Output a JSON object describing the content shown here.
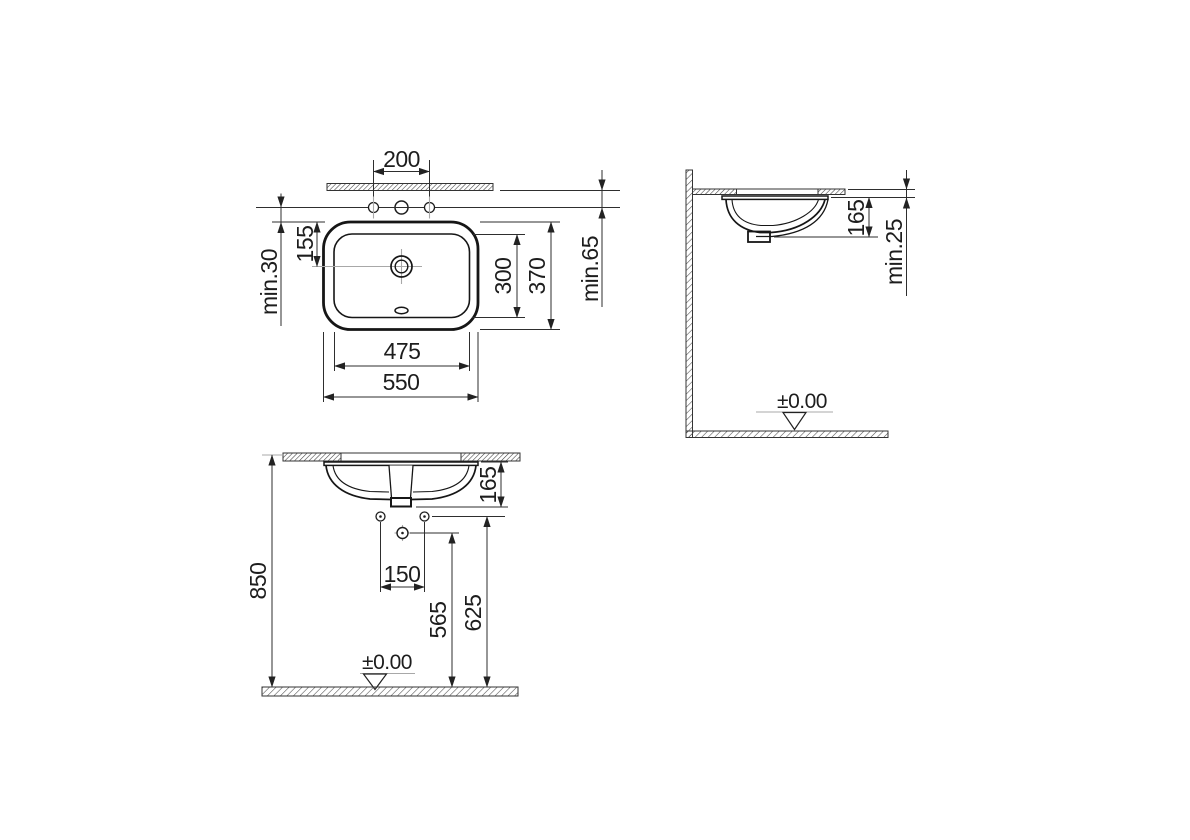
{
  "drawing": {
    "background": "#ffffff",
    "line_color": "#161616",
    "dimension_color": "#2e2e2e",
    "centerline_color": "#a8a8a8",
    "plan": {
      "tap_hole_spacing": "200",
      "edge_to_tap_min": "min.65",
      "tap_to_rim_min": "min.30",
      "rim_to_drain": "155",
      "bowl_depth": "300",
      "overall_depth": "370",
      "bowl_width": "475",
      "overall_width": "550"
    },
    "side": {
      "depth_below_counter": "165",
      "counter_thickness_min": "min.25",
      "floor_datum": "±0.00"
    },
    "front": {
      "depth_below_counter": "165",
      "supply_spacing": "150",
      "drain_height": "565",
      "supply_height": "625",
      "counter_height": "850",
      "floor_datum": "±0.00"
    }
  }
}
